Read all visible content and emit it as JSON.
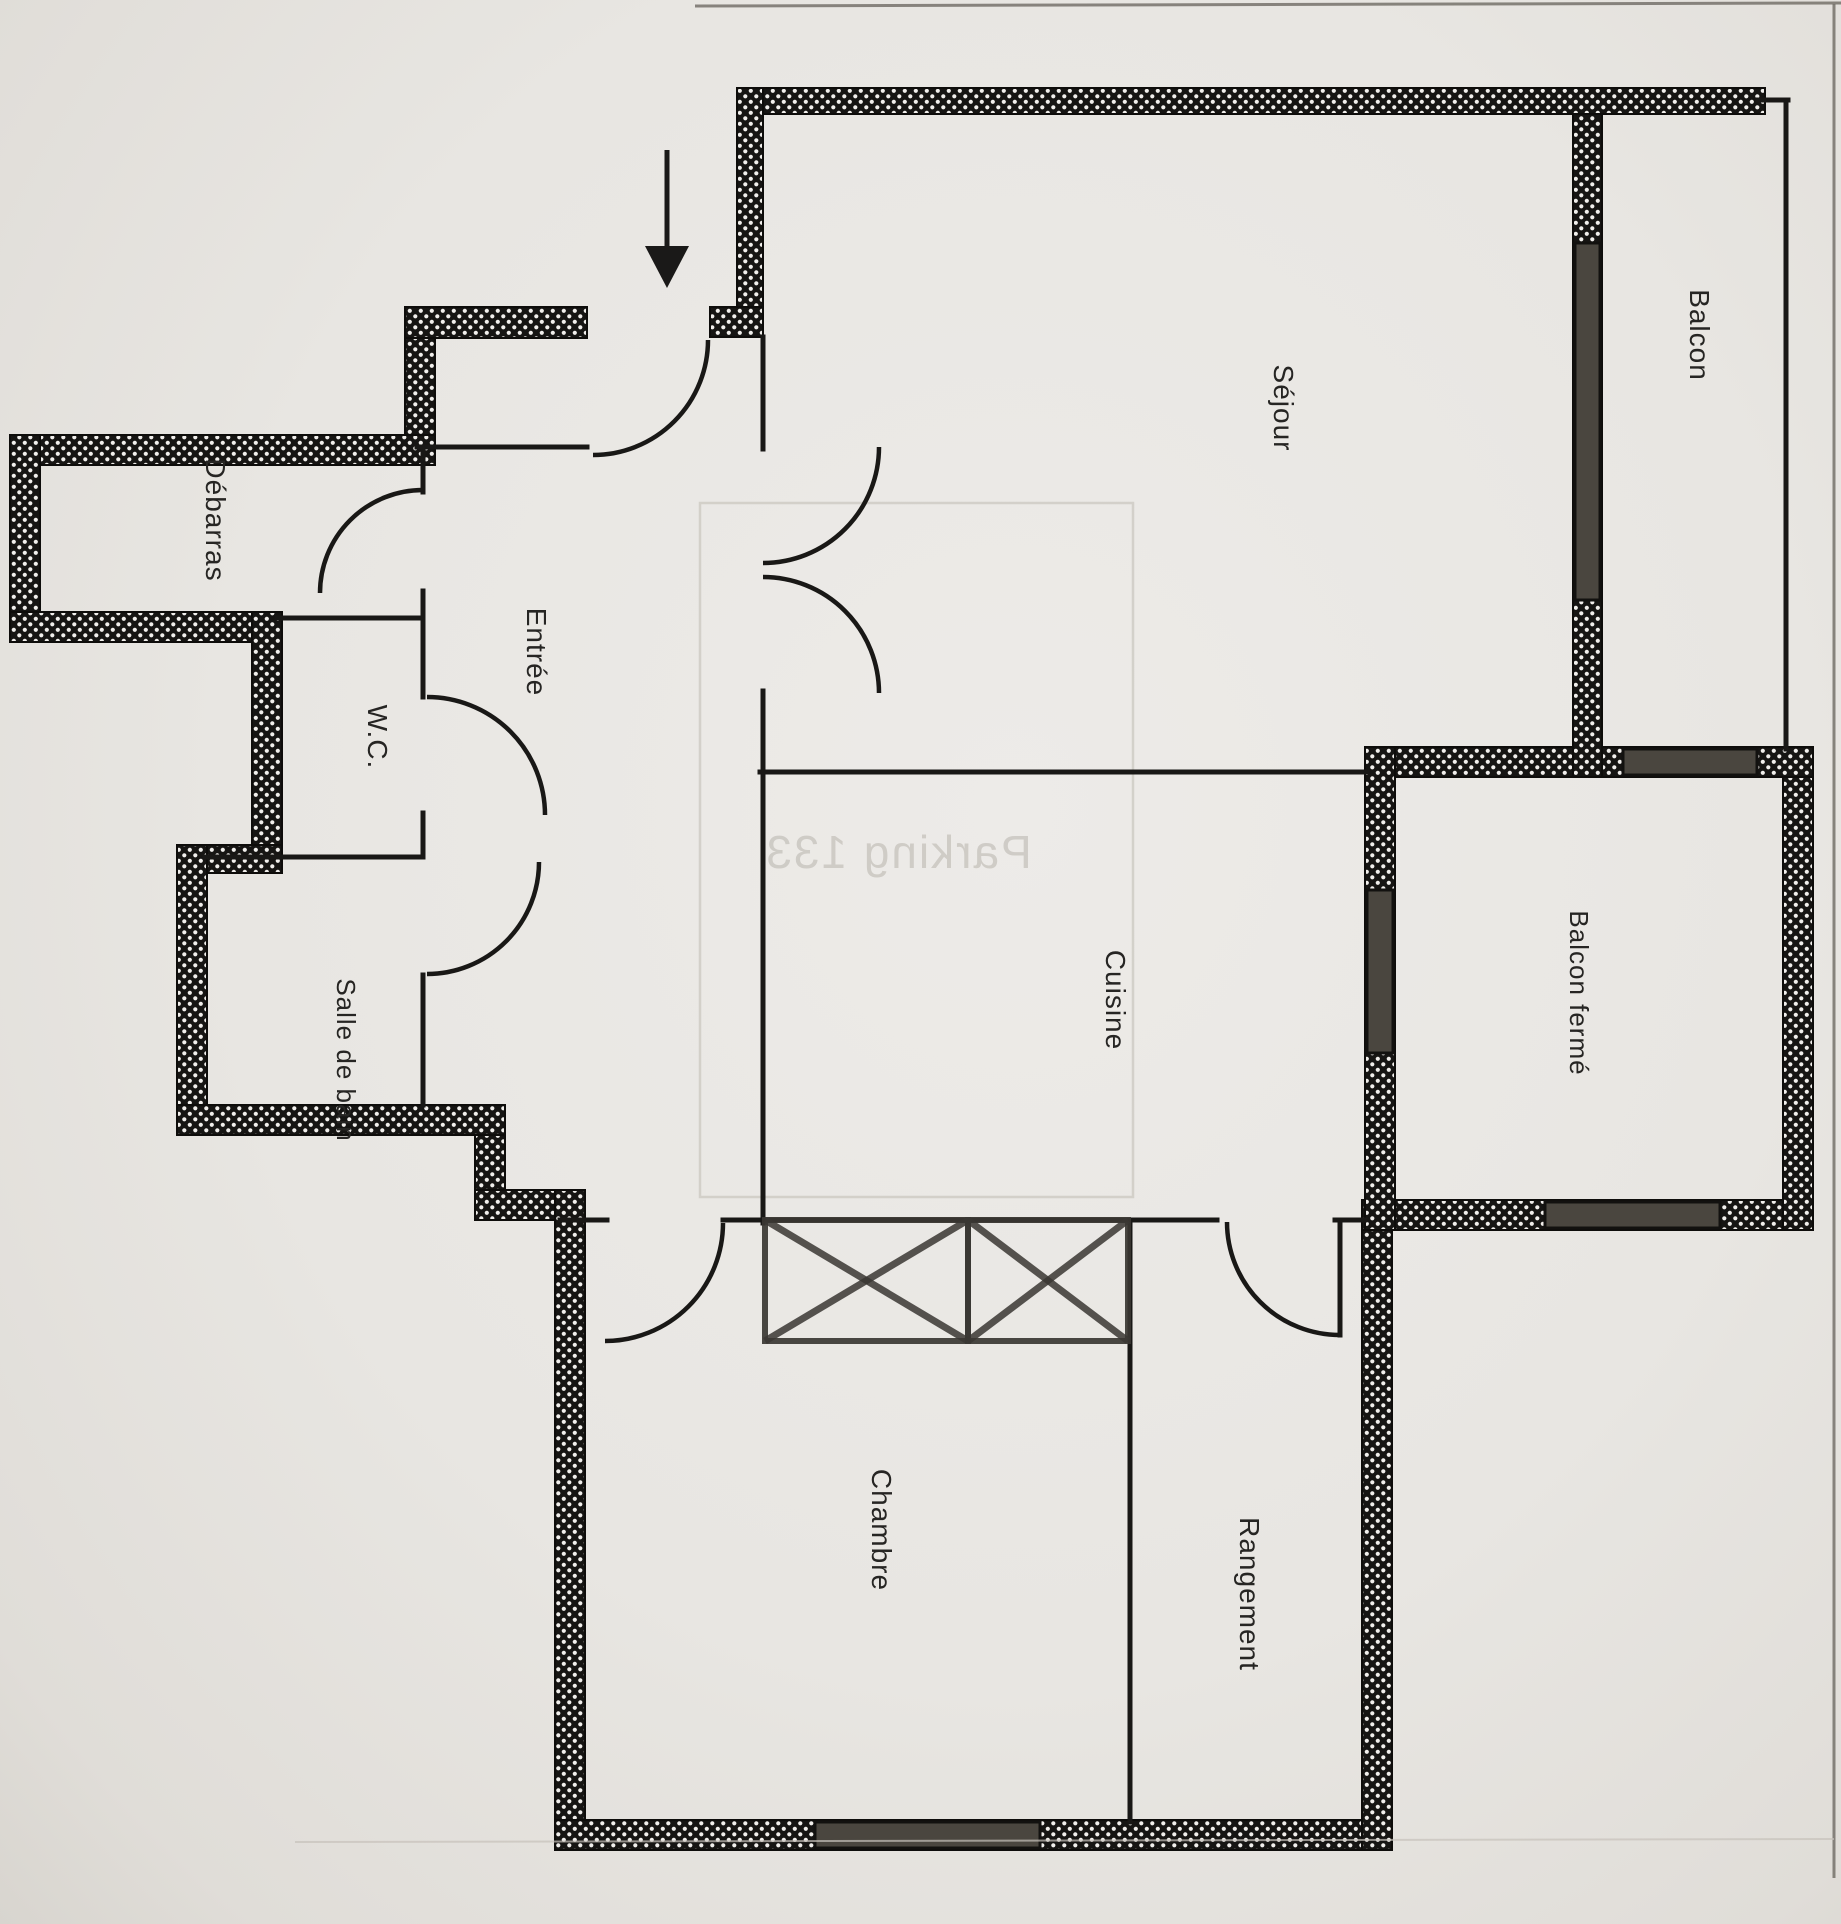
{
  "page": {
    "title": "Plan d'appartement (scan)",
    "background": "#e8e6e2"
  },
  "plan": {
    "colors": {
      "wall_fill": "#161513",
      "wall_dot": "#f1efec",
      "wall_stroke": "#0e0d0b",
      "thin_line": "#191816",
      "window_fill": "#4a463f",
      "window_stroke": "#12110f",
      "closet_stroke": "#3a3733",
      "arrow": "#1a1918",
      "watermark_color": "#a8a39b",
      "bleed_line": "#c0bbb2",
      "page_edge_dark": "#6f6b64",
      "page_edge_soft": "#c7c2bb"
    },
    "labels": [
      {
        "id": "balcon",
        "text": "Balcon",
        "x": 1690,
        "y": 335,
        "size": 28
      },
      {
        "id": "sejour",
        "text": "Séjour",
        "x": 1274,
        "y": 408,
        "size": 28
      },
      {
        "id": "debarras",
        "text": "Débarras",
        "x": 206,
        "y": 520,
        "size": 28
      },
      {
        "id": "wc",
        "text": "W.C.",
        "x": 368,
        "y": 737,
        "size": 28
      },
      {
        "id": "entree",
        "text": "Entrée",
        "x": 527,
        "y": 652,
        "size": 28
      },
      {
        "id": "salle-de-bain",
        "text": "Salle de bain",
        "x": 337,
        "y": 1060,
        "size": 26
      },
      {
        "id": "cuisine",
        "text": "Cuisine",
        "x": 1106,
        "y": 1000,
        "size": 28
      },
      {
        "id": "balcon-ferme",
        "text": "Balcon fermé",
        "x": 1570,
        "y": 993,
        "size": 26
      },
      {
        "id": "chambre",
        "text": "Chambre",
        "x": 872,
        "y": 1530,
        "size": 28
      },
      {
        "id": "rangement",
        "text": "Rangement",
        "x": 1240,
        "y": 1594,
        "size": 28
      }
    ],
    "watermark": {
      "text": "Parking 133",
      "x": 898,
      "y": 868,
      "size": 46,
      "opacity": 0.42,
      "box": {
        "x": 700,
        "y": 503,
        "w": 433,
        "h": 694,
        "opacity": 0.55
      }
    },
    "arrow": {
      "x": 667,
      "y1": 150,
      "y2": 252,
      "head": "645,246 689,246 667,288"
    },
    "exterior_walls": [
      [
        737,
        88,
        1028,
        26
      ],
      [
        737,
        88,
        26,
        249
      ],
      [
        710,
        307,
        53,
        30
      ],
      [
        405,
        307,
        182,
        31
      ],
      [
        405,
        338,
        30,
        127
      ],
      [
        10,
        435,
        425,
        30
      ],
      [
        10,
        435,
        30,
        207
      ],
      [
        10,
        612,
        272,
        30
      ],
      [
        252,
        612,
        30,
        233
      ],
      [
        177,
        845,
        105,
        28
      ],
      [
        177,
        845,
        30,
        290
      ],
      [
        177,
        1105,
        328,
        30
      ],
      [
        475,
        1135,
        30,
        85
      ],
      [
        475,
        1190,
        110,
        30
      ],
      [
        555,
        1190,
        30,
        660
      ],
      [
        555,
        1820,
        837,
        30
      ],
      [
        1362,
        1200,
        30,
        650
      ],
      [
        1362,
        1200,
        451,
        30
      ],
      [
        1783,
        747,
        30,
        483
      ],
      [
        1365,
        747,
        448,
        30
      ],
      [
        1365,
        747,
        30,
        483
      ],
      [
        1573,
        114,
        29,
        663
      ]
    ],
    "windows": [
      [
        1575,
        243,
        25,
        357
      ],
      [
        1623,
        749,
        134,
        26
      ],
      [
        1367,
        890,
        26,
        163
      ],
      [
        1545,
        1202,
        175,
        26
      ],
      [
        815,
        1822,
        225,
        26
      ]
    ],
    "thin_walls": [
      [
        417,
        447,
        587,
        447
      ],
      [
        423,
        447,
        423,
        492
      ],
      [
        423,
        591,
        423,
        620
      ],
      [
        277,
        618,
        423,
        618
      ],
      [
        423,
        618,
        423,
        697
      ],
      [
        423,
        813,
        423,
        857
      ],
      [
        205,
        857,
        423,
        857
      ],
      [
        423,
        975,
        423,
        1105
      ],
      [
        760,
        772,
        1367,
        772
      ],
      [
        763,
        337,
        763,
        449
      ],
      [
        763,
        691,
        763,
        1223
      ],
      [
        560,
        1220,
        607,
        1220
      ],
      [
        723,
        1220,
        1217,
        1220
      ],
      [
        1335,
        1220,
        1365,
        1220
      ],
      [
        1130,
        1220,
        1130,
        1822
      ],
      [
        1340,
        1222,
        1340,
        1335
      ],
      [
        1786,
        100,
        1786,
        749
      ],
      [
        1758,
        100,
        1788,
        100
      ]
    ],
    "door_arcs": [
      {
        "name": "entry-door",
        "r": 115,
        "sx": 708,
        "sy": 340,
        "ex": 593,
        "ey": 455,
        "sweep": 1
      },
      {
        "name": "debarras-door",
        "r": 103,
        "sx": 423,
        "sy": 490,
        "ex": 320,
        "ey": 593,
        "sweep": 0
      },
      {
        "name": "wc-door",
        "r": 118,
        "sx": 427,
        "sy": 697,
        "ex": 545,
        "ey": 815,
        "sweep": 1
      },
      {
        "name": "bath-door",
        "r": 112,
        "sx": 539,
        "sy": 862,
        "ex": 427,
        "ey": 974,
        "sweep": 1
      },
      {
        "name": "sejour-door-upper",
        "r": 116,
        "sx": 879,
        "sy": 447,
        "ex": 763,
        "ey": 563,
        "sweep": 1
      },
      {
        "name": "sejour-door-lower",
        "r": 116,
        "sx": 763,
        "sy": 577,
        "ex": 879,
        "ey": 693,
        "sweep": 1
      },
      {
        "name": "chambre-door",
        "r": 118,
        "sx": 723,
        "sy": 1223,
        "ex": 605,
        "ey": 1341,
        "sweep": 1
      },
      {
        "name": "rangement-door",
        "r": 113,
        "sx": 1227,
        "sy": 1222,
        "ex": 1340,
        "ey": 1335,
        "sweep": 0
      }
    ],
    "closets": [
      [
        765,
        1220,
        203,
        121
      ],
      [
        968,
        1220,
        160,
        121
      ]
    ],
    "page_edges": [
      {
        "x1": 695,
        "y1": 6,
        "x2": 1841,
        "y2": 3,
        "w": 3,
        "tone": "dark"
      },
      {
        "x1": 1834,
        "y1": 4,
        "x2": 1834,
        "y2": 1878,
        "w": 3,
        "tone": "dark"
      },
      {
        "x1": 295,
        "y1": 1842,
        "x2": 1834,
        "y2": 1839,
        "w": 2,
        "tone": "soft"
      }
    ]
  }
}
